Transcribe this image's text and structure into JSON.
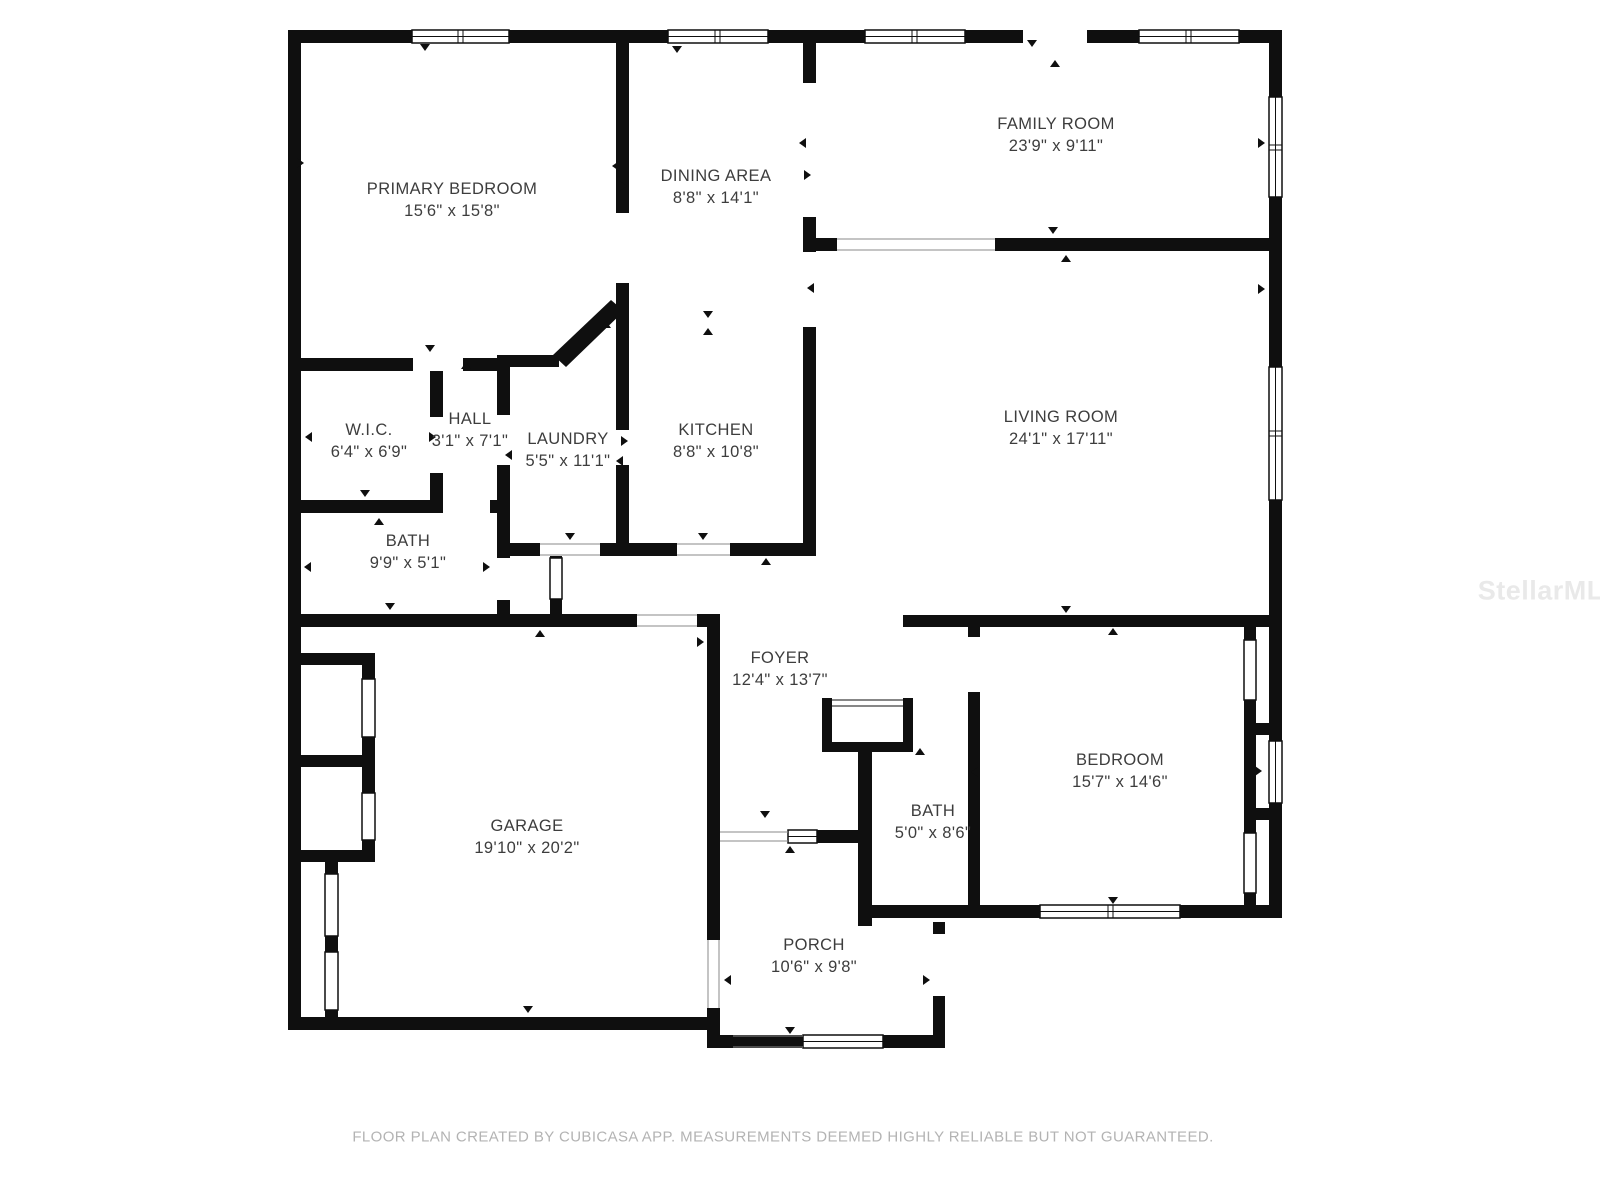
{
  "plan": {
    "colors": {
      "wall": "#0f0f0f",
      "label_text": "#3d3d3d",
      "footer_text": "#b3b3b3",
      "watermark_text": "#e9e9e9",
      "background": "#ffffff"
    },
    "rooms": [
      {
        "id": "primary-bedroom",
        "name": "PRIMARY BEDROOM",
        "dims": "15'6\" x 15'8\""
      },
      {
        "id": "dining-area",
        "name": "DINING AREA",
        "dims": "8'8\" x 14'1\""
      },
      {
        "id": "family-room",
        "name": "FAMILY ROOM",
        "dims": "23'9\" x 9'11\""
      },
      {
        "id": "living-room",
        "name": "LIVING ROOM",
        "dims": "24'1\" x 17'11\""
      },
      {
        "id": "wic",
        "name": "W.I.C.",
        "dims": "6'4\" x 6'9\""
      },
      {
        "id": "hall",
        "name": "HALL",
        "dims": "3'1\" x 7'1\""
      },
      {
        "id": "laundry",
        "name": "LAUNDRY",
        "dims": "5'5\" x 11'1\""
      },
      {
        "id": "kitchen",
        "name": "KITCHEN",
        "dims": "8'8\" x 10'8\""
      },
      {
        "id": "bath-1",
        "name": "BATH",
        "dims": "9'9\" x 5'1\""
      },
      {
        "id": "foyer",
        "name": "FOYER",
        "dims": "12'4\" x 13'7\""
      },
      {
        "id": "garage",
        "name": "GARAGE",
        "dims": "19'10\" x 20'2\""
      },
      {
        "id": "bath-2",
        "name": "BATH",
        "dims": "5'0\" x 8'6\""
      },
      {
        "id": "bedroom",
        "name": "BEDROOM",
        "dims": "15'7\" x 14'6\""
      },
      {
        "id": "porch",
        "name": "PORCH",
        "dims": "10'6\" x 9'8\""
      }
    ]
  },
  "footer": {
    "disclaimer": "FLOOR PLAN CREATED BY CUBICASA APP. MEASUREMENTS DEEMED HIGHLY RELIABLE BUT NOT GUARANTEED."
  },
  "watermark": {
    "text": "StellarMLS"
  }
}
